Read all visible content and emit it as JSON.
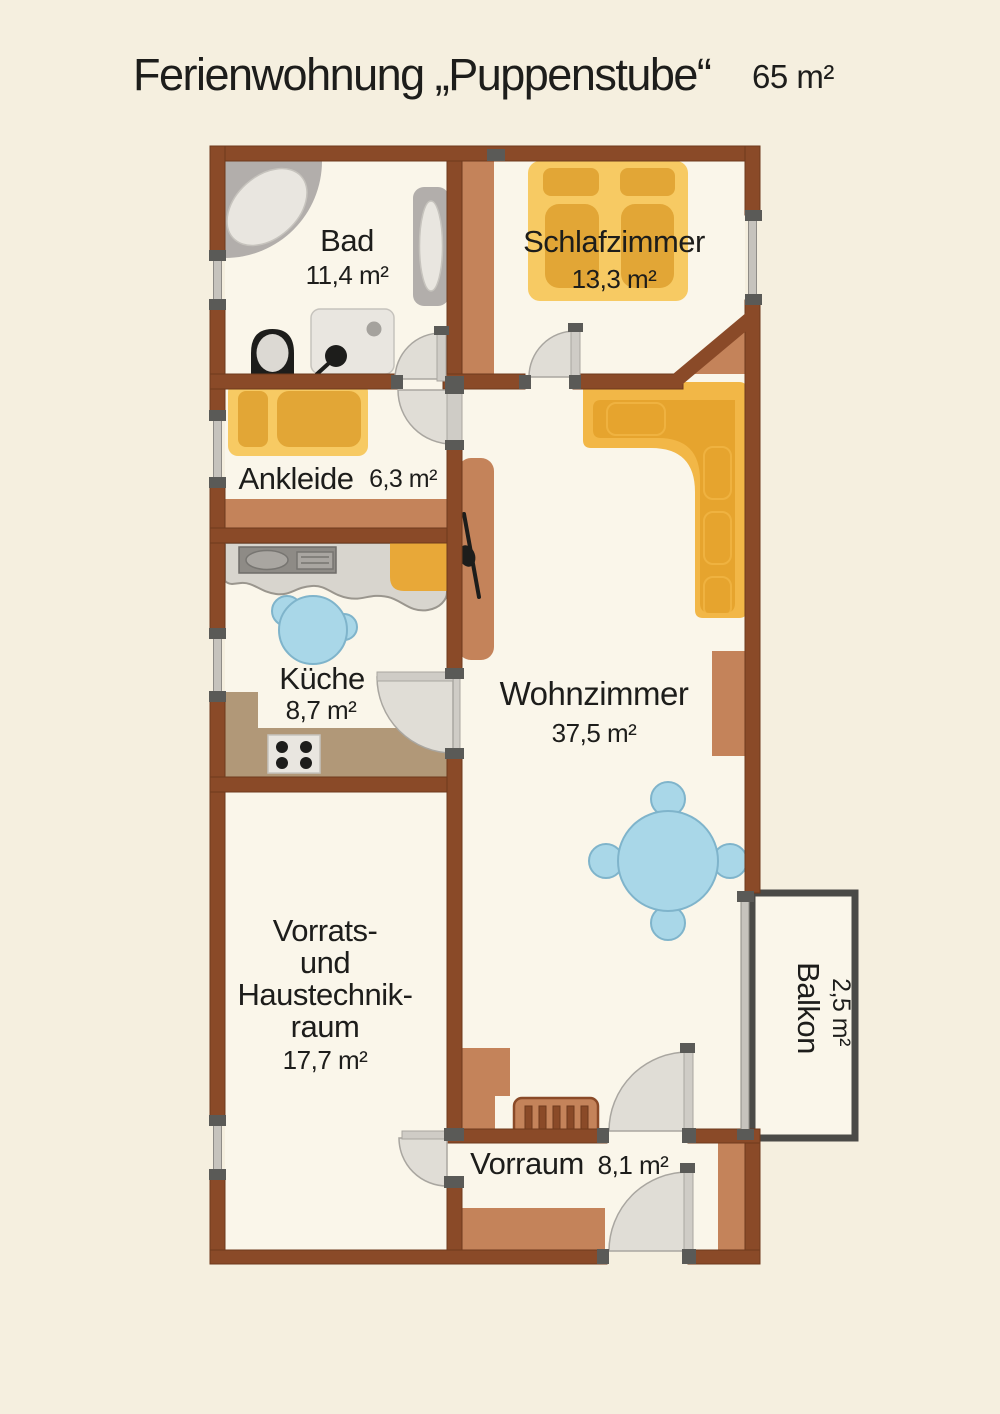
{
  "title": {
    "text": "Ferienwohnung „Puppenstube“",
    "area": "65 m²"
  },
  "rooms": {
    "bad": {
      "name": "Bad",
      "area": "11,4 m²"
    },
    "schlafzimmer": {
      "name": "Schlafzimmer",
      "area": "13,3 m²"
    },
    "ankleide": {
      "name": "Ankleide",
      "area": "6,3 m²"
    },
    "kueche": {
      "name": "Küche",
      "area": "8,7 m²"
    },
    "wohnzimmer": {
      "name": "Wohnzimmer",
      "area": "37,5 m²"
    },
    "vorrat": {
      "line1": "Vorrats-",
      "line2": "und",
      "line3": "Haustechnik-",
      "line4": "raum",
      "area": "17,7 m²"
    },
    "vorraum": {
      "name": "Vorraum",
      "area": "8,1 m²"
    },
    "balkon": {
      "name": "Balkon",
      "area": "2,5 m²"
    }
  },
  "colors": {
    "background": "#f5efdf",
    "floor": "#faf6ea",
    "wall": "#8a4a28",
    "wallEdge": "#6e3a1d",
    "furnBrown": "#c4835a",
    "counterTan": "#b19878",
    "bedBase": "#f7ca63",
    "bedDark": "#e2a636",
    "sofaBack": "#f2b747",
    "sofaSeat": "#e6a42e",
    "accentOrange": "#e8a838",
    "tableBlue": "#a9d7e8",
    "tableBlueEdge": "#7fb4cb",
    "fixGray": "#b2aeab",
    "fixLight": "#e9e6e0",
    "counterGray": "#d8d5ce",
    "applianceDark": "#8e8b86",
    "doorFill": "#e0ddd6",
    "doorEdge": "#a9a6a0",
    "leafGray": "#cfccc6",
    "capGray": "#5a5a57",
    "frameDark": "#4a4a47",
    "text": "#1d1d1b"
  }
}
